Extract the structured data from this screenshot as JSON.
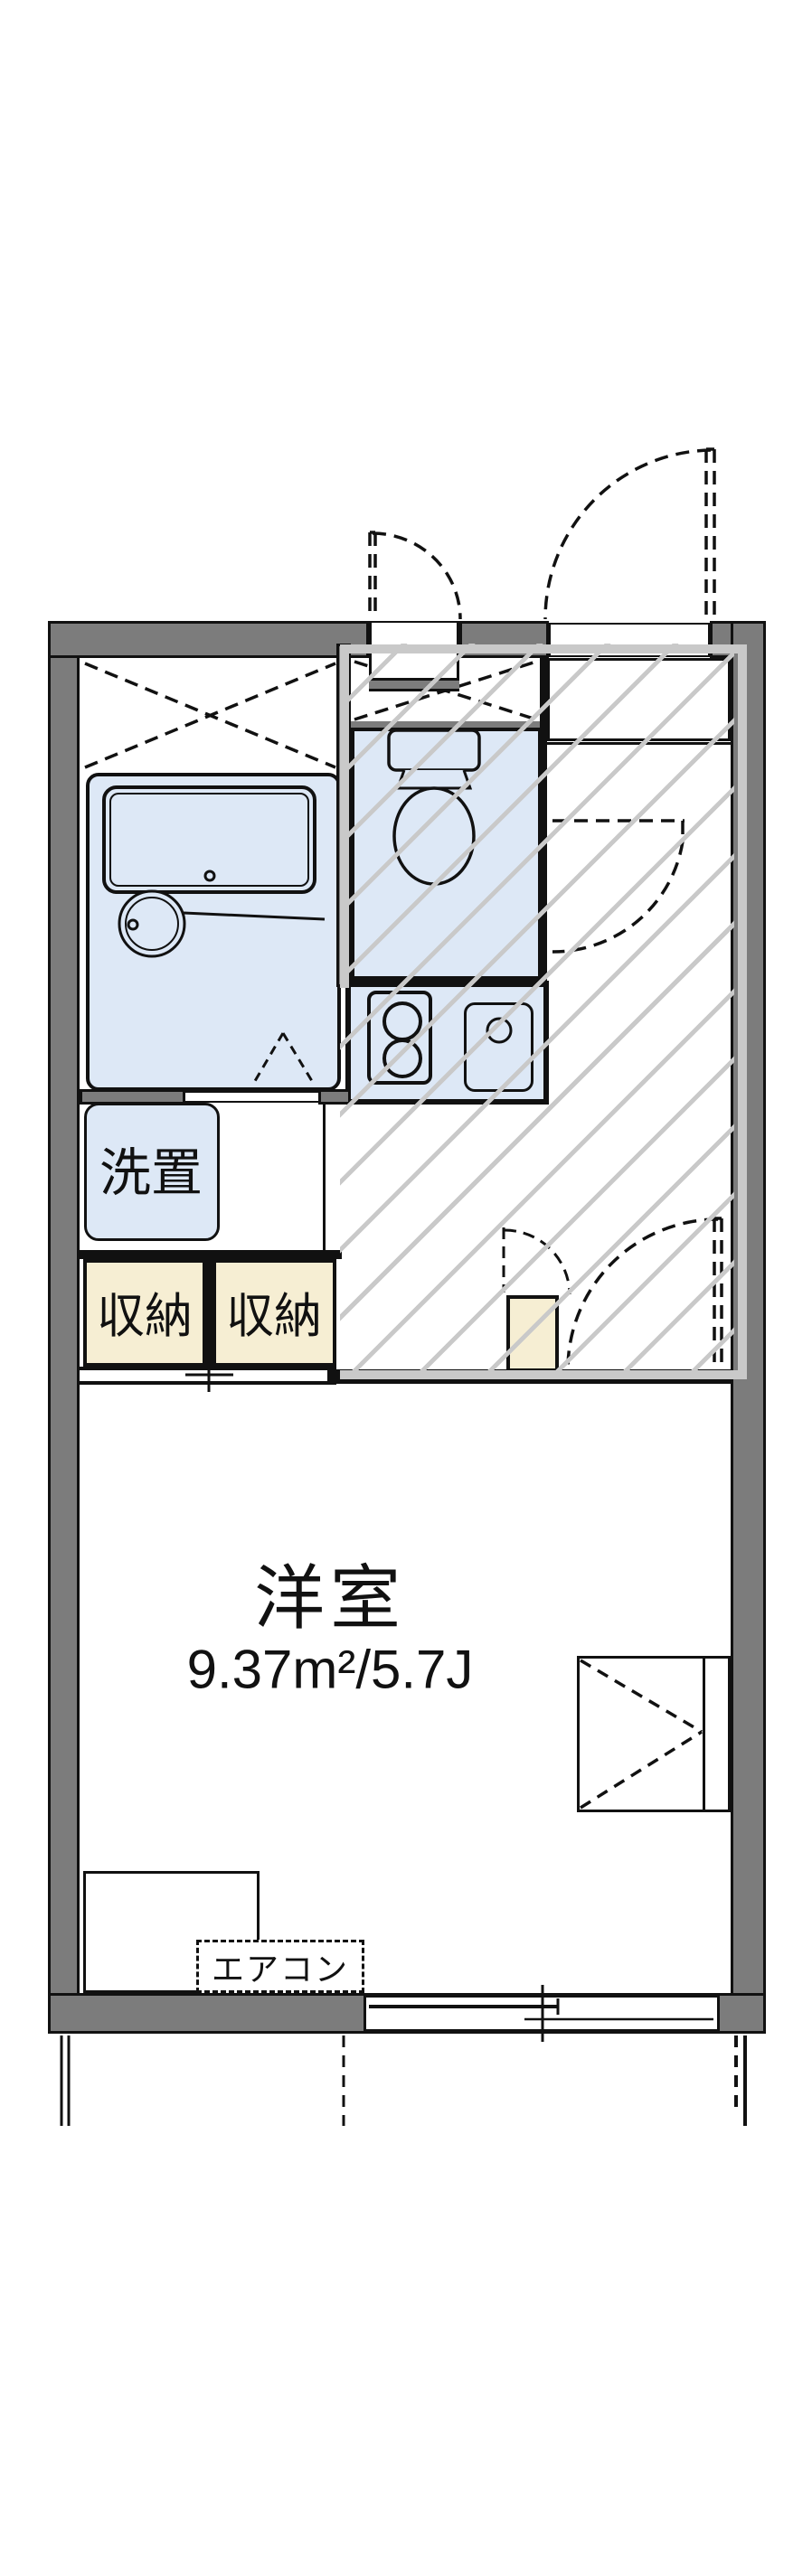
{
  "floorplan": {
    "main_room": {
      "label": "洋室",
      "area": "9.37m²/5.7J"
    },
    "washer_space": {
      "label": "洗置"
    },
    "storage_left": {
      "label": "収納"
    },
    "storage_right": {
      "label": "収納"
    },
    "aircon": {
      "label": "エアコン"
    },
    "colors": {
      "wall": "#7c7c7c",
      "wet_area_fill": "#dde8f6",
      "storage_fill": "#f6eed3",
      "hatch_line": "#c9c9c9",
      "line": "#111111"
    }
  }
}
